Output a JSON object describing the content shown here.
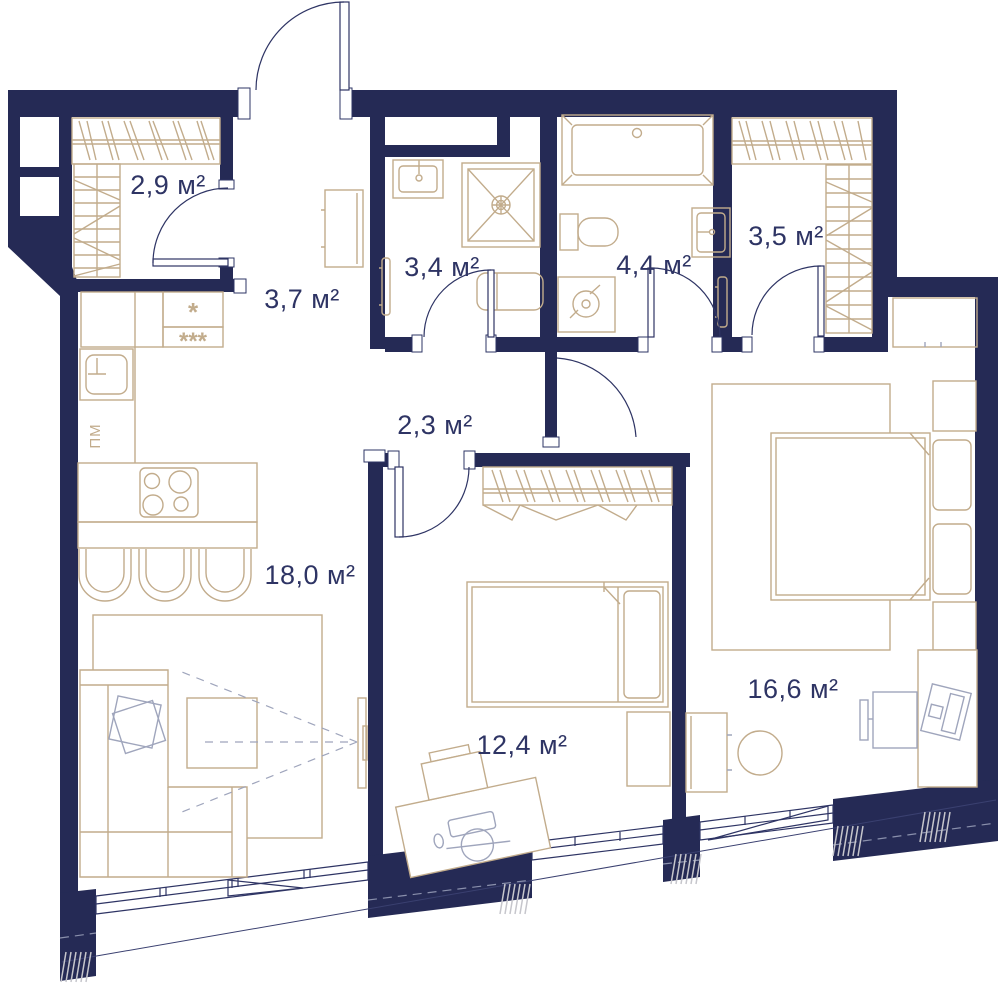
{
  "meta": {
    "type": "apartment-floor-plan"
  },
  "colors": {
    "wall": "#252A55",
    "furniture": "#C2AC8C",
    "line": "#2E3464",
    "accessory": "#9FA5BC",
    "hatch": "#C6C6CC"
  },
  "rooms": [
    {
      "id": "closet",
      "label": "2,9 м²"
    },
    {
      "id": "hallway",
      "label": "3,7 м²"
    },
    {
      "id": "bathroom-small",
      "label": "3,4 м²"
    },
    {
      "id": "bathroom-large",
      "label": "4,4 м²"
    },
    {
      "id": "wardrobe",
      "label": "3,5 м²"
    },
    {
      "id": "corridor",
      "label": "2,3 м²"
    },
    {
      "id": "kitchen-living",
      "label": "18,0 м²"
    },
    {
      "id": "bedroom",
      "label": "12,4 м²"
    },
    {
      "id": "bedroom-master",
      "label": "16,6 м²"
    }
  ],
  "appliances": {
    "dishwasher": "ПМ",
    "fridge_star": "*",
    "fridge_stars": "***"
  }
}
